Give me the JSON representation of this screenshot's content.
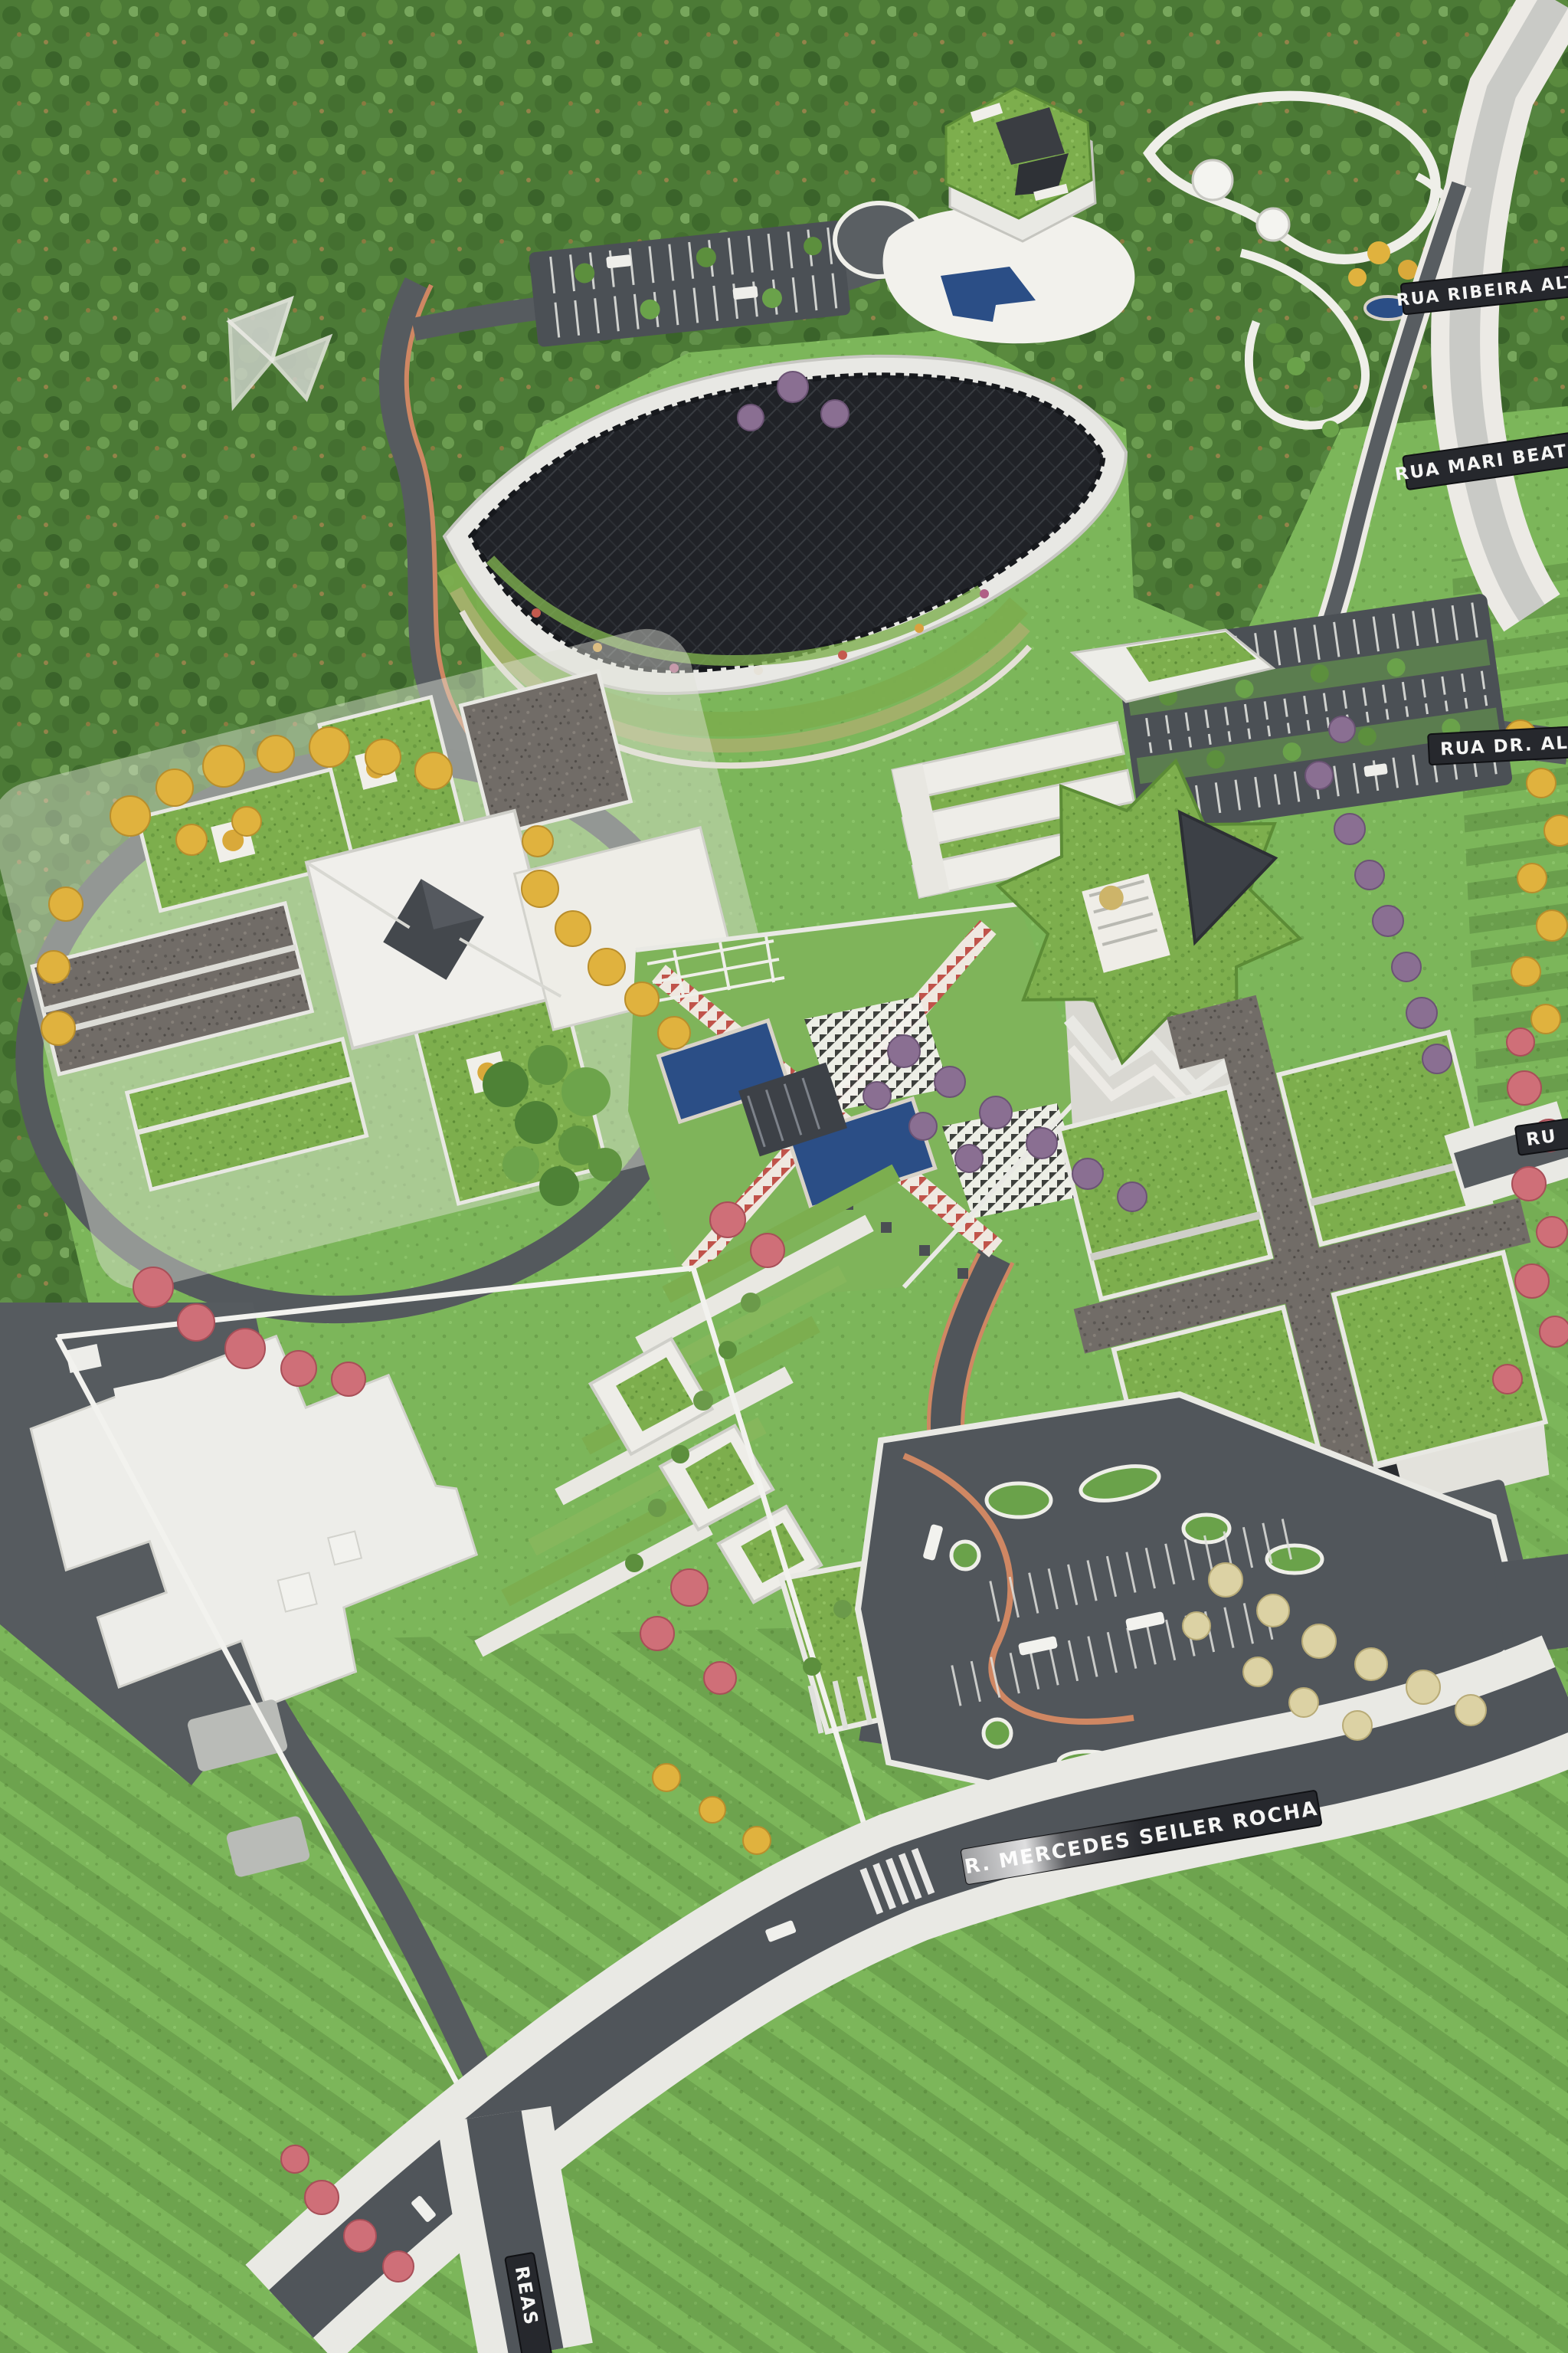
{
  "scene": {
    "description": "Aerial photo of an architectural scale model: green campus masterplan with green-roof buildings, leaf-shaped solar canopy building, star tower, cross-shaped building, transit hub, parking lots, roads and modelled trees"
  },
  "street_labels": {
    "top_right_1": "RUA RIBEIRA ALTA",
    "top_right_2": "RUA MARI BEATRIZ",
    "right_mid": "RUA DR. AL",
    "right_lower": "RU",
    "bottom_main": "R. MERCEDES SEILER ROCHA",
    "bottom_left_vertical": "REAS"
  },
  "palette": {
    "grass_base": "#7ab356",
    "forest": "#4c7a36",
    "lawn_light": "#8cbf66",
    "road": "#565b5f",
    "road_dark": "#4b5055",
    "sidewalk": "#e9e9e4",
    "accent_path": "#cf8763",
    "leaf_canopy_black": "#202227",
    "green_roof": "#7dae4d",
    "gravel_roof": "#716c67",
    "building_white": "#efefea",
    "water": "#2b4e86",
    "label_plate": "#26282d",
    "label_text": "#f5f5f4",
    "tree_yellow": "#e0b23e",
    "tree_pink": "#cf6f78",
    "tree_purple": "#8a6f92",
    "tree_cream": "#dcd2a4",
    "tree_green": "#5c8f3d"
  }
}
